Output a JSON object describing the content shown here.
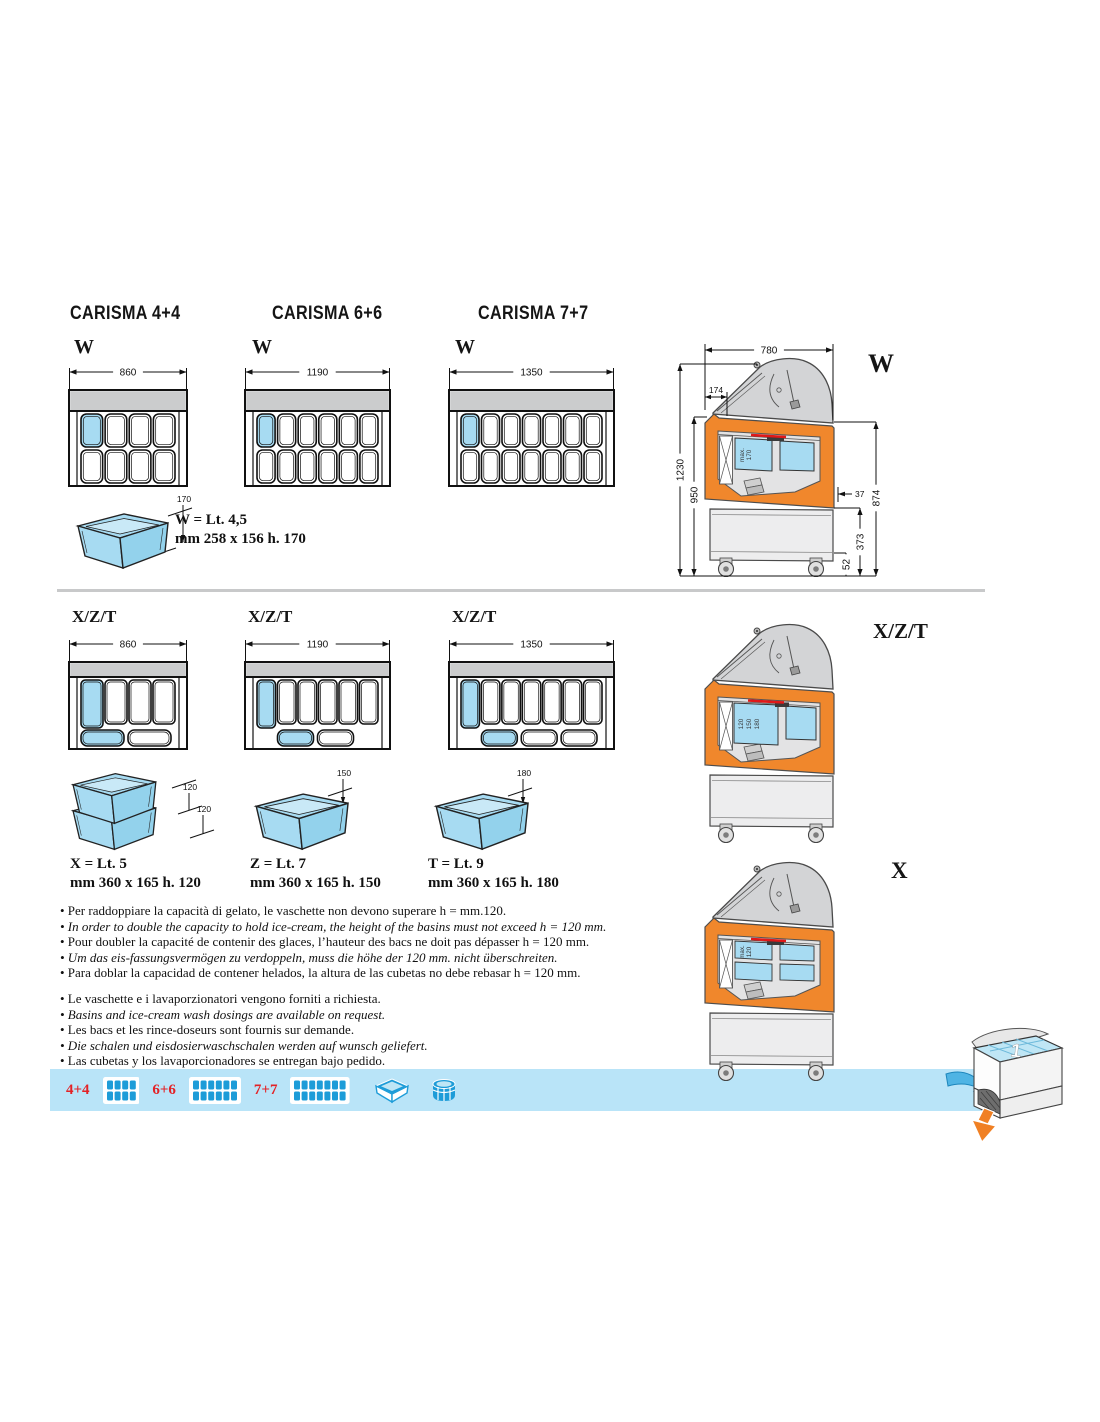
{
  "colors": {
    "basin_blue": "#a7dbf2",
    "band_gray": "#cbcccd",
    "orange": "#f0872c",
    "bar_blue": "#b9e4f8",
    "red_label": "#e32226",
    "icon_blue": "#1d9cd8",
    "red_detail": "#e01818"
  },
  "sections": {
    "w": {
      "models": [
        {
          "title": "CARISMA 4+4",
          "variant_label": "W",
          "width_mm": "860",
          "cols": 4,
          "rows": 2
        },
        {
          "title": "CARISMA 6+6",
          "variant_label": "W",
          "width_mm": "1190",
          "cols": 6,
          "rows": 2
        },
        {
          "title": "CARISMA 7+7",
          "variant_label": "W",
          "width_mm": "1350",
          "cols": 7,
          "rows": 2
        }
      ],
      "basin": {
        "height_dim": "170",
        "spec_line1": "W = Lt. 4,5",
        "spec_line2": "mm 258 x 156 h. 170"
      },
      "side_view": {
        "label": "W",
        "dim_top_width": "780",
        "dim_lid": "174",
        "dim_total_height": "1230",
        "dim_body_height": "950",
        "dim_right_total": "874",
        "dim_right_lower": "373",
        "dim_right_bottom": "52",
        "dim_offset": "37",
        "basin_depth_line1": "max.",
        "basin_depth_line2": "170"
      }
    },
    "xzt": {
      "models": [
        {
          "variant_label": "X/Z/T",
          "width_mm": "860",
          "cols": 4,
          "bottom_basins": 2,
          "bottom_offset": 0
        },
        {
          "variant_label": "X/Z/T",
          "width_mm": "1190",
          "cols": 6,
          "bottom_basins": 2,
          "bottom_offset": 1
        },
        {
          "variant_label": "X/Z/T",
          "width_mm": "1350",
          "cols": 7,
          "bottom_basins": 3,
          "bottom_offset": 1
        }
      ],
      "basins": [
        {
          "dim_labels": [
            "120",
            "120"
          ],
          "spec_line1": "X = Lt. 5",
          "spec_line2": "mm 360 x 165 h. 120",
          "stacked": true
        },
        {
          "dim_labels": [
            "150"
          ],
          "spec_line1": "Z = Lt. 7",
          "spec_line2": "mm 360 x 165 h. 150",
          "stacked": false
        },
        {
          "dim_labels": [
            "180"
          ],
          "spec_line1": "T = Lt. 9",
          "spec_line2": "mm 360 x 165 h. 180",
          "stacked": false
        }
      ],
      "side_view_xzt": {
        "label": "X/Z/T",
        "basin_depths": [
          "120",
          "150",
          "180"
        ]
      },
      "side_view_x": {
        "label": "X",
        "basin_depth_line1": "max.",
        "basin_depth_line2": "120"
      }
    }
  },
  "notes": {
    "block1": [
      {
        "text": "Per raddoppiare la capacità di gelato, le vaschette non devono superare h = mm.120.",
        "italic": false
      },
      {
        "text": "In order to double the capacity to hold ice-cream, the height of the basins must not exceed h = 120 mm.",
        "italic": true
      },
      {
        "text": "Pour doubler la capacité de contenir des glaces, l’hauteur des bacs ne doit pas dépasser h = 120 mm.",
        "italic": false
      },
      {
        "text": "Um das eis-fassungsvermögen zu verdoppeln, muss die höhe der 120 mm. nicht überschreiten.",
        "italic": true
      },
      {
        "text": "Para doblar la capacidad de contener helados, la altura de las cubetas no debe rebasar h = 120 mm.",
        "italic": false
      }
    ],
    "block2": [
      {
        "text": "Le vaschette e i lavaporzionatori vengono forniti a richiesta.",
        "italic": false
      },
      {
        "text": "Basins and ice-cream wash dosings are available on request.",
        "italic": true
      },
      {
        "text": "Les bacs et les rince-doseurs sont fournis sur demande.",
        "italic": false
      },
      {
        "text": "Die schalen und eisdosierwaschschalen werden auf wunsch geliefert.",
        "italic": true
      },
      {
        "text": "Las cubetas y los lavaporcionadores se entregan bajo pedido.",
        "italic": false
      }
    ]
  },
  "legend_bar": {
    "items": [
      {
        "label": "4+4",
        "cols": 4
      },
      {
        "label": "6+6",
        "cols": 6
      },
      {
        "label": "7+7",
        "cols": 7
      }
    ],
    "icons": [
      "basin-icon",
      "tub-icon"
    ]
  },
  "corner_illustration": {
    "number": "1"
  }
}
